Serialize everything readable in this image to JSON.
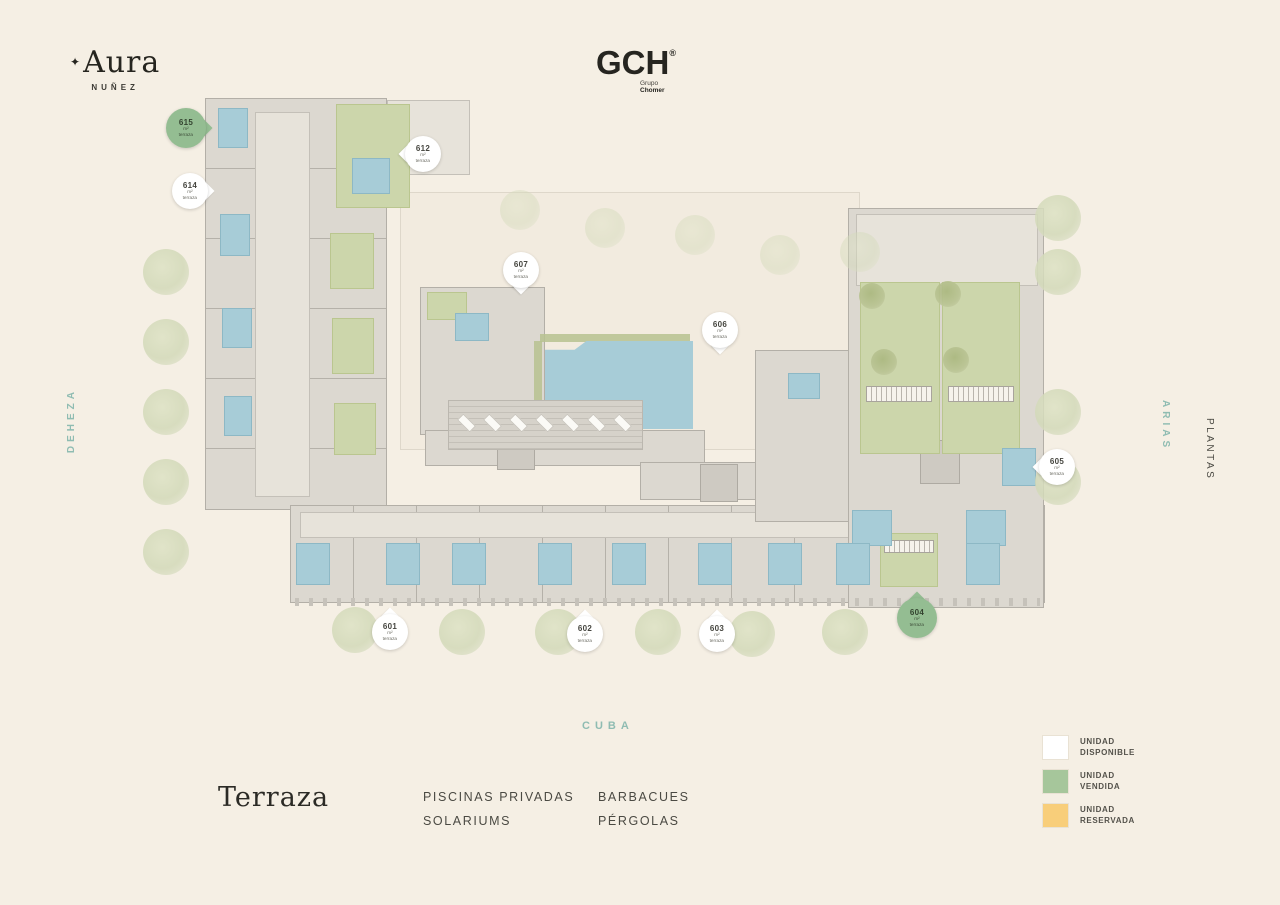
{
  "header": {
    "brand": {
      "mark": "✦",
      "name": "Aura",
      "subtitle": "NUÑEZ"
    },
    "developer": {
      "name": "GCH",
      "reg": "®",
      "group_line1": "Grupo",
      "group_line2": "Chomer"
    }
  },
  "streets": {
    "west": "DEHEZA",
    "east": "ARIAS",
    "south": "CUBA"
  },
  "nav": {
    "plans_label": "PLANTAS"
  },
  "footer": {
    "floor_title": "Terraza",
    "features_col1": [
      "PISCINAS PRIVADAS",
      "SOLARIUMS"
    ],
    "features_col2": [
      "BARBACUES",
      "PÉRGOLAS"
    ]
  },
  "legend": {
    "available": {
      "line1": "UNIDAD",
      "line2": "DISPONIBLE",
      "color": "#ffffff"
    },
    "sold": {
      "line1": "UNIDAD",
      "line2": "VENDIDA",
      "color": "#a6c69b"
    },
    "reserved": {
      "line1": "UNIDAD",
      "line2": "RESERVADA",
      "color": "#f8ce7a"
    }
  },
  "status_colors": {
    "disponible": "#ffffff",
    "vendida": "#94bd92",
    "reservada": "#f8ce7a"
  },
  "units": {
    "pins": [
      {
        "number": "615",
        "area_label": "m²",
        "terrace_label": "terraza",
        "status": "vendida"
      },
      {
        "number": "614",
        "area_label": "m²",
        "terrace_label": "terraza",
        "status": "disponible"
      },
      {
        "number": "612",
        "area_label": "m²",
        "terrace_label": "terraza",
        "status": "disponible"
      },
      {
        "number": "607",
        "area_label": "m²",
        "terrace_label": "terraza",
        "status": "disponible"
      },
      {
        "number": "606",
        "area_label": "m²",
        "terrace_label": "terraza",
        "status": "disponible"
      },
      {
        "number": "605",
        "area_label": "m²",
        "terrace_label": "terraza",
        "status": "disponible"
      },
      {
        "number": "604",
        "area_label": "m²",
        "terrace_label": "terraza",
        "status": "vendida"
      },
      {
        "number": "603",
        "area_label": "m²",
        "terrace_label": "terraza",
        "status": "disponible"
      },
      {
        "number": "602",
        "area_label": "m²",
        "terrace_label": "terraza",
        "status": "disponible"
      },
      {
        "number": "601",
        "area_label": "m²",
        "terrace_label": "terraza",
        "status": "disponible"
      }
    ]
  },
  "plan_colors": {
    "background": "#f5efe4",
    "building_gray": "#dcd8d0",
    "pool_blue": "#a7ccd7",
    "terrace_green": "#ccd6ab",
    "street_text_teal": "#8fbcb2"
  }
}
